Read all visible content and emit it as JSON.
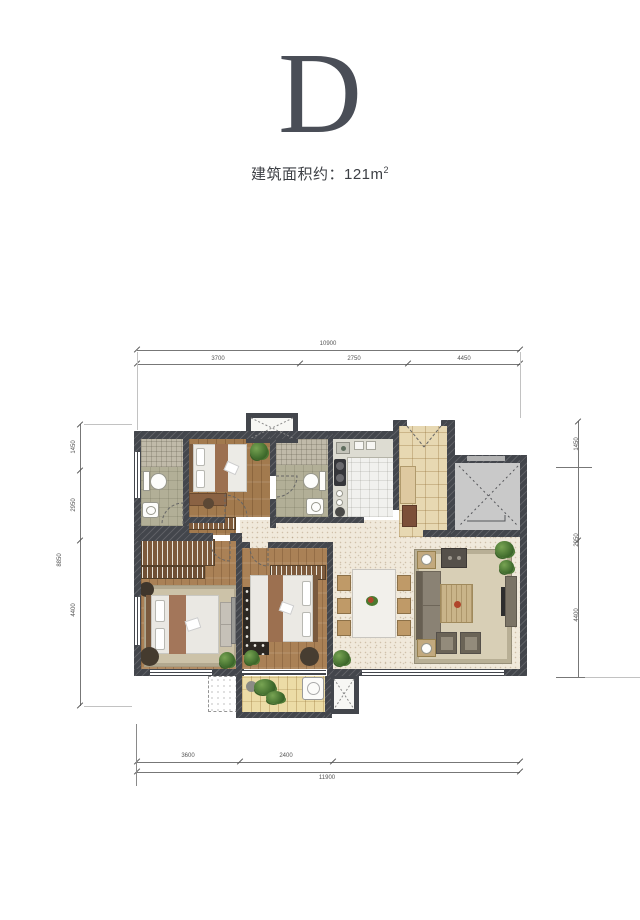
{
  "header": {
    "plan_letter": "D",
    "area_prefix": "建筑面积约：",
    "area_value": "121m",
    "area_sup": "2"
  },
  "dimensions": {
    "top": {
      "total": "10900",
      "segments": [
        "3700",
        "2750",
        "4450"
      ]
    },
    "bottom": {
      "total": "11900",
      "segments": [
        "3600",
        "2400"
      ]
    },
    "left": {
      "total": "8850",
      "segments": [
        "1450",
        "2950",
        "4400"
      ]
    },
    "right": {
      "segments": [
        "1450",
        "2950",
        "4400"
      ]
    }
  },
  "colors": {
    "letter": "#4a4e57",
    "label_text": "#3c3f44",
    "wall": "#43464c",
    "wood_floor": "#a27a4e",
    "bath_tile": "#b2af97",
    "kitchen_tile": "#f1f1ee",
    "main_floor": "#f0e9db",
    "foyer_tile": "#e7d8b2",
    "balcony_deck": "#ecdca6",
    "elevator": "#c9c9c9",
    "rug": "#d8cfb6",
    "plant": "#3f6b2c"
  }
}
